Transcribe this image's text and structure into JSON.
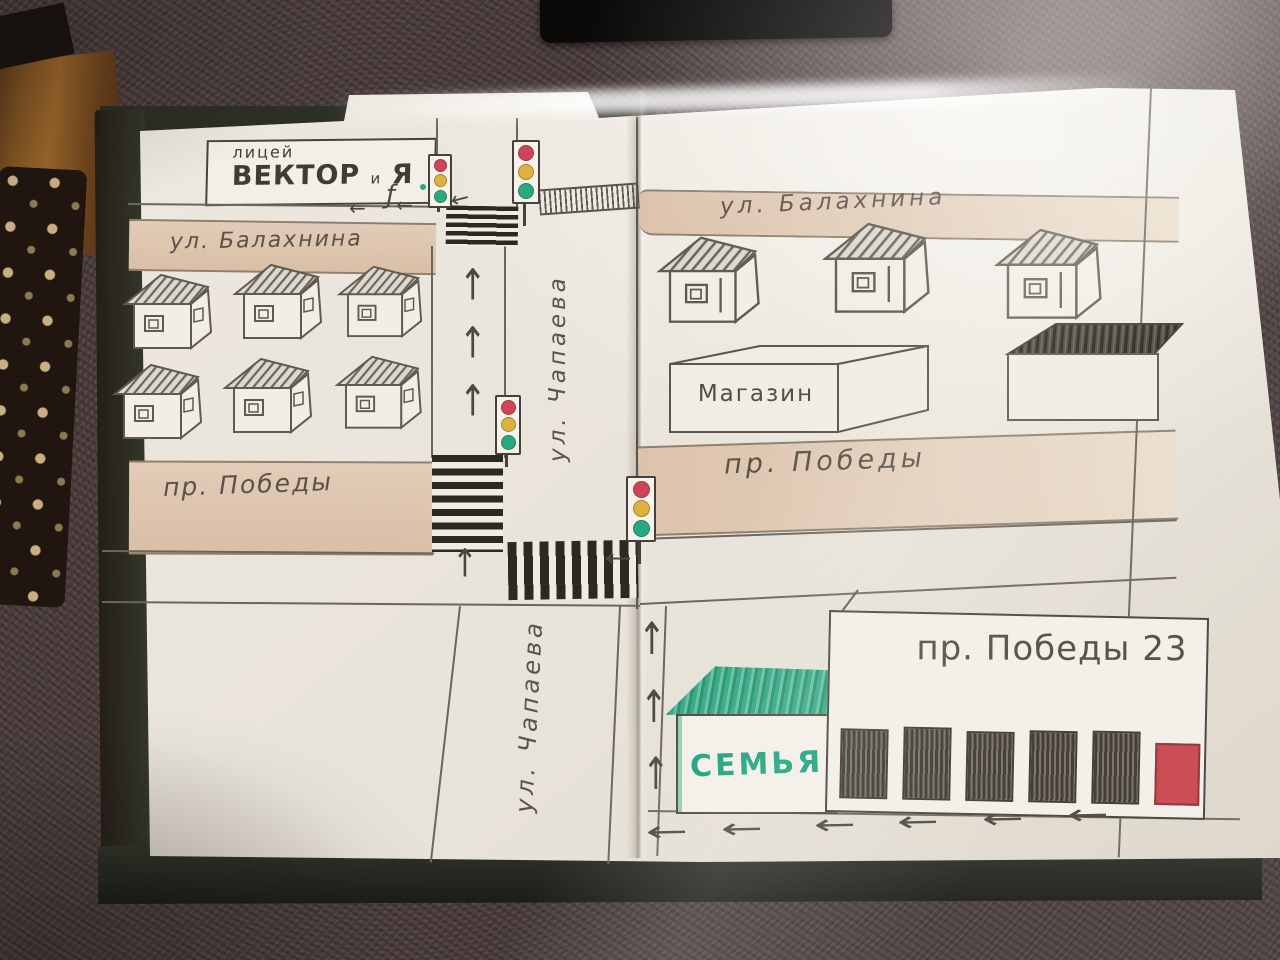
{
  "map": {
    "streets": {
      "balakhnina_left": "ул. Балахнина",
      "balakhnina_right": "ул. Балахнина",
      "chapaeva_upper": "ул. Чапаева",
      "chapaeva_lower": "ул. Чапаева",
      "pobedy_left": "пр. Победы",
      "pobedy_right": "пр. Победы"
    },
    "buildings": {
      "lyceum_type": "лицей",
      "lyceum_name": "ВЕКТОР",
      "lyceum_conj": "и",
      "lyceum_suffix": "Я",
      "shop": "Магазин",
      "family_store": "СЕМЬЯ",
      "address_building": "пр. Победы 23"
    },
    "symbols": {
      "arrow_up": "↑",
      "arrow_left": "←",
      "route_mark": "ƒ"
    },
    "colors": {
      "street_tan": "#ddc5ae",
      "pencil_gray": "#55504a",
      "traffic_red": "#cf4456",
      "traffic_yellow": "#ddb23e",
      "traffic_green": "#29a981",
      "store_green": "#1ea47e",
      "door_red": "#c8454e"
    }
  }
}
